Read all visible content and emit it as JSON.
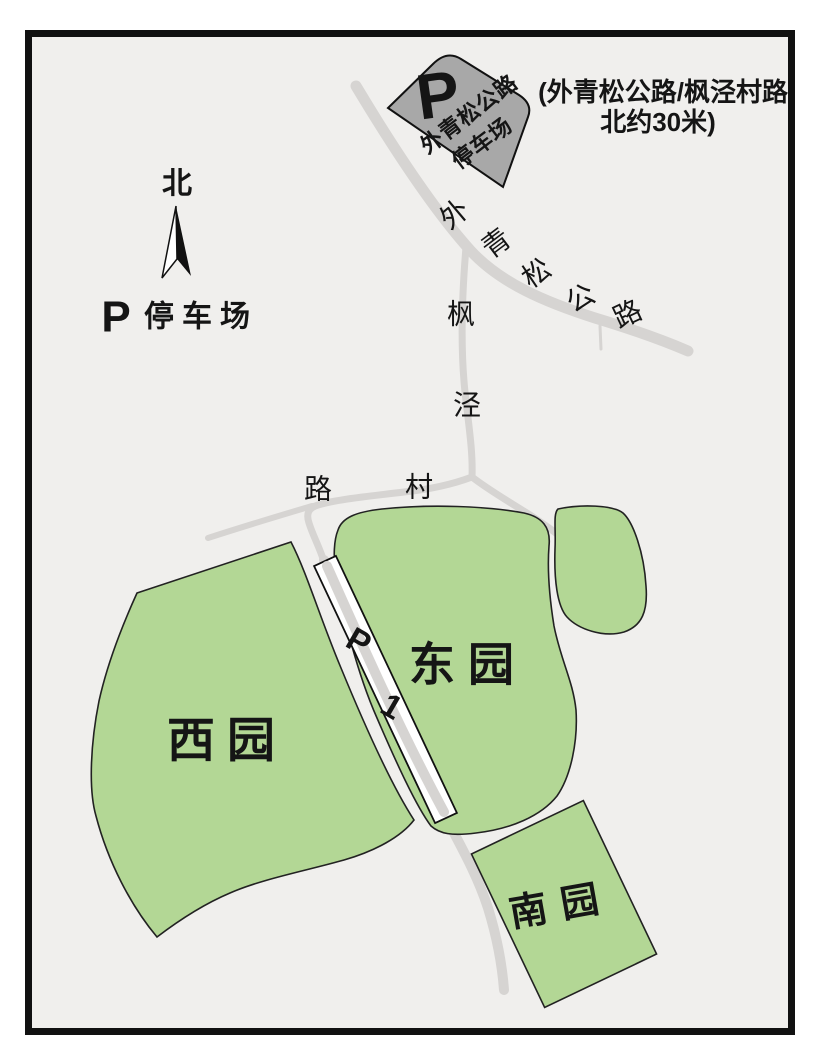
{
  "colors": {
    "frame": "#111111",
    "map_bg": "#f0efed",
    "road": "#d6d4d2",
    "garden_fill": "#b3d795",
    "garden_stroke": "#222222",
    "parking_box_fill": "#a8a8a8",
    "strip_fill": "#ffffff",
    "note_red": "#e11d1d",
    "ink": "#151515"
  },
  "compass": {
    "label": "北"
  },
  "legend": {
    "symbol": "P",
    "label": "停车场"
  },
  "note": {
    "line1": "(外青松公路/枫泾村路",
    "line2": "北约30米)"
  },
  "roadside_parking_box": {
    "symbol": "P",
    "name_line1": "外青松公路",
    "name_line2": "停车场"
  },
  "road_labels": {
    "waiqingsong": [
      "外",
      "青",
      "松",
      "公",
      "路"
    ],
    "fengjing": [
      "枫",
      "泾",
      "村",
      "路"
    ]
  },
  "parking_strip": {
    "symbol": "P",
    "number": "1"
  },
  "gardens": {
    "west": "西园",
    "east": "东园",
    "south": "南园"
  }
}
